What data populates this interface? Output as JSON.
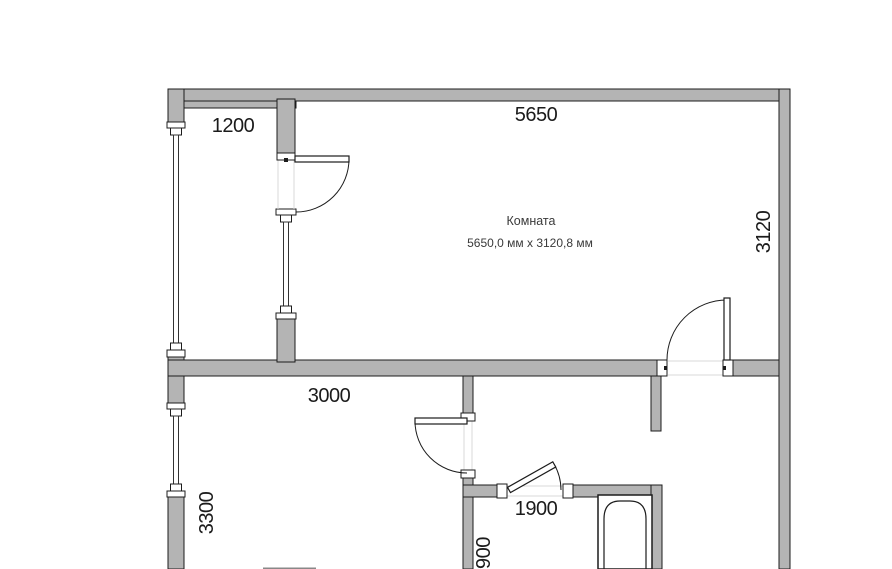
{
  "room_label": {
    "name": "Комната",
    "size": "5650,0 мм x 3120,8 мм"
  },
  "dimensions": {
    "top_width": "5650",
    "balcony_width": "1200",
    "room_depth": "3120",
    "lower_room_width": "3000",
    "lower_room_depth": "3300",
    "bathroom_width": "1900",
    "bathroom_depth": "900"
  },
  "colors": {
    "wall_fill": "#b4b4b4",
    "outline": "#1c1c1c",
    "dimension_text": "#1b1b1b",
    "room_label_text": "#3a3a3a",
    "background": "#ffffff"
  }
}
